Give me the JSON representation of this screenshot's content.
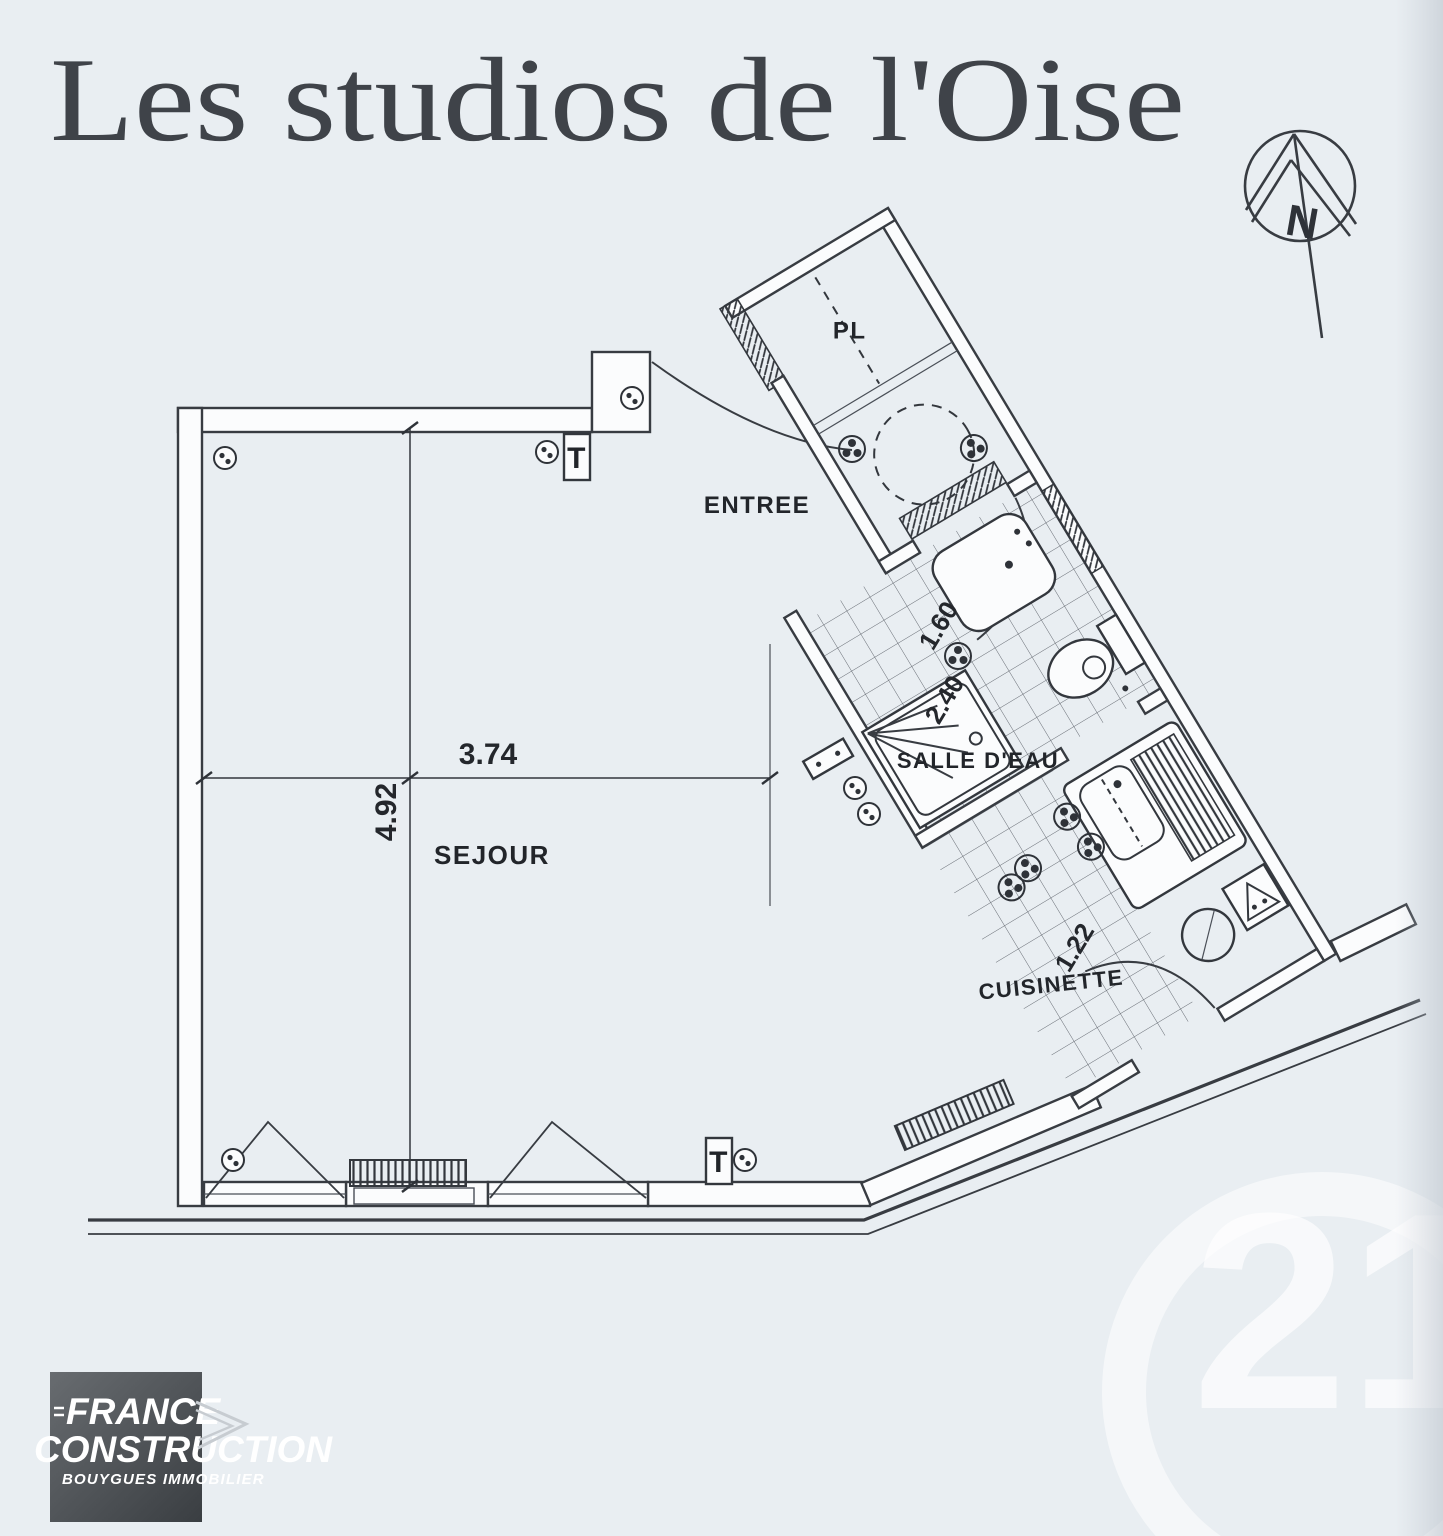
{
  "title": "Les studios de l'Oise",
  "north_letter": "N",
  "rooms": {
    "entree": "ENTREE",
    "sejour": "SEJOUR",
    "salle_deau": "SALLE D'EAU",
    "cuisinette": "CUISINETTE",
    "placard": "PL"
  },
  "dimensions": {
    "sejour_width": "3.74",
    "sejour_depth": "4.92",
    "salle_deau_width": "1.60",
    "salle_deau_depth": "2.40",
    "cuisinette_width": "1.22"
  },
  "symbols": {
    "thermostat": "T"
  },
  "logo": {
    "line1": "FRANCE",
    "line2": "CONSTRUCTION",
    "line3": "BOUYGUES IMMOBILIER"
  },
  "watermark": {
    "number": "21"
  },
  "colors": {
    "paper": "#e9eef2",
    "ink": "#33373d",
    "logo_background": "#4c5054",
    "watermark": "#ffffff"
  }
}
